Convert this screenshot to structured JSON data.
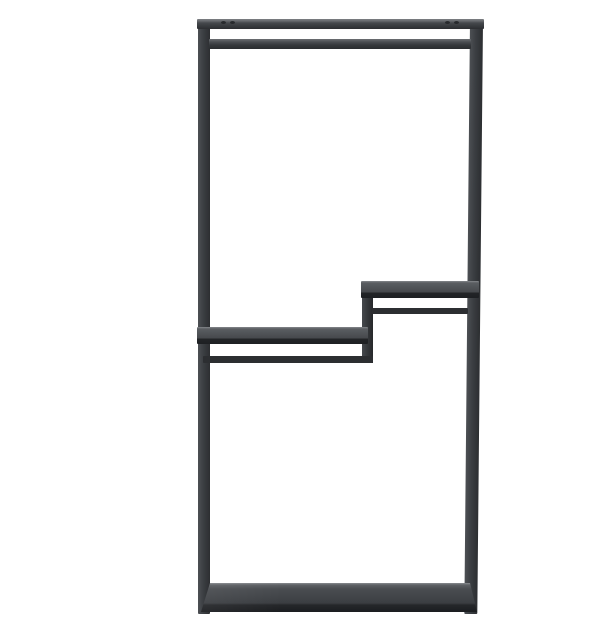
{
  "image": {
    "kind": "product-photo",
    "description": "Studio photo of a tall rectangular matte-black metal shelving unit / clothes rack on a plain white background: top frame bar with a hanging rail beneath it, two staggered mid-height shelves joined by a vertical step, thin support bars under each shelf, and a solid bottom shelf slab.",
    "background": "#ffffff"
  },
  "product": {
    "name": "black-metal-shelving-rack",
    "finish": "matte black metal",
    "parts": {
      "top_bar": {
        "label": "Top frame bar"
      },
      "hanging_rail": {
        "label": "Hanging rail"
      },
      "left_post": {
        "label": "Left frame post"
      },
      "right_post": {
        "label": "Right frame post"
      },
      "upper_shelf": {
        "label": "Upper right shelf"
      },
      "upper_shelf_support": {
        "label": "Upper shelf support bar"
      },
      "step_connector": {
        "label": "Shelf step connector"
      },
      "lower_shelf": {
        "label": "Lower left shelf"
      },
      "lower_shelf_support": {
        "label": "Lower shelf support bar"
      },
      "bottom_shelf": {
        "label": "Bottom shelf slab"
      },
      "screws": {
        "label": "Top bar fixing screws"
      }
    }
  },
  "colors": {
    "background": "#ffffff",
    "frame_light": "#4d5054",
    "frame_mid": "#3b3e42",
    "frame_dark": "#2c2e31",
    "shelf_highlight": "#85888c",
    "shelf_top": "#46494d",
    "shelf_edge": "#232528",
    "slab_surface": "#4a4d51",
    "slab_front": "#1b1d20"
  }
}
